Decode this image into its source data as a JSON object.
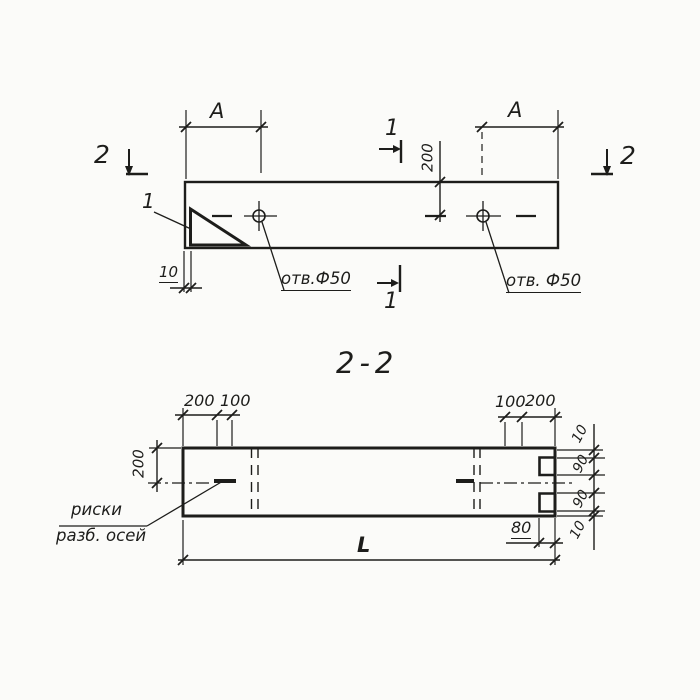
{
  "colors": {
    "paper": "#fbfbf9",
    "ink": "#1d1d1b"
  },
  "top_view": {
    "dim_a_left": "A",
    "dim_a_right": "A",
    "dim_200_vert": "200",
    "dim_10": "10",
    "hole_label_left": "отв.Ф50",
    "hole_label_right": "отв. Ф50",
    "detail_ref": "1",
    "section_1_top": "1",
    "section_1_bottom": "1",
    "section_2_left": "2",
    "section_2_right": "2"
  },
  "section_view": {
    "title": "2-2",
    "dim_200_top_left": "200",
    "dim_100_top_left": "100",
    "dim_100_top_right": "100",
    "dim_200_top_right": "200",
    "dim_200_left_vert": "200",
    "dim_10_right_top": "10",
    "dim_90_right_top": "90",
    "dim_90_right_bottom": "90",
    "dim_10_right_bottom": "10",
    "dim_80": "80",
    "dim_length": "L",
    "axes_note_line1": "риски",
    "axes_note_line2": "разб. осей"
  }
}
